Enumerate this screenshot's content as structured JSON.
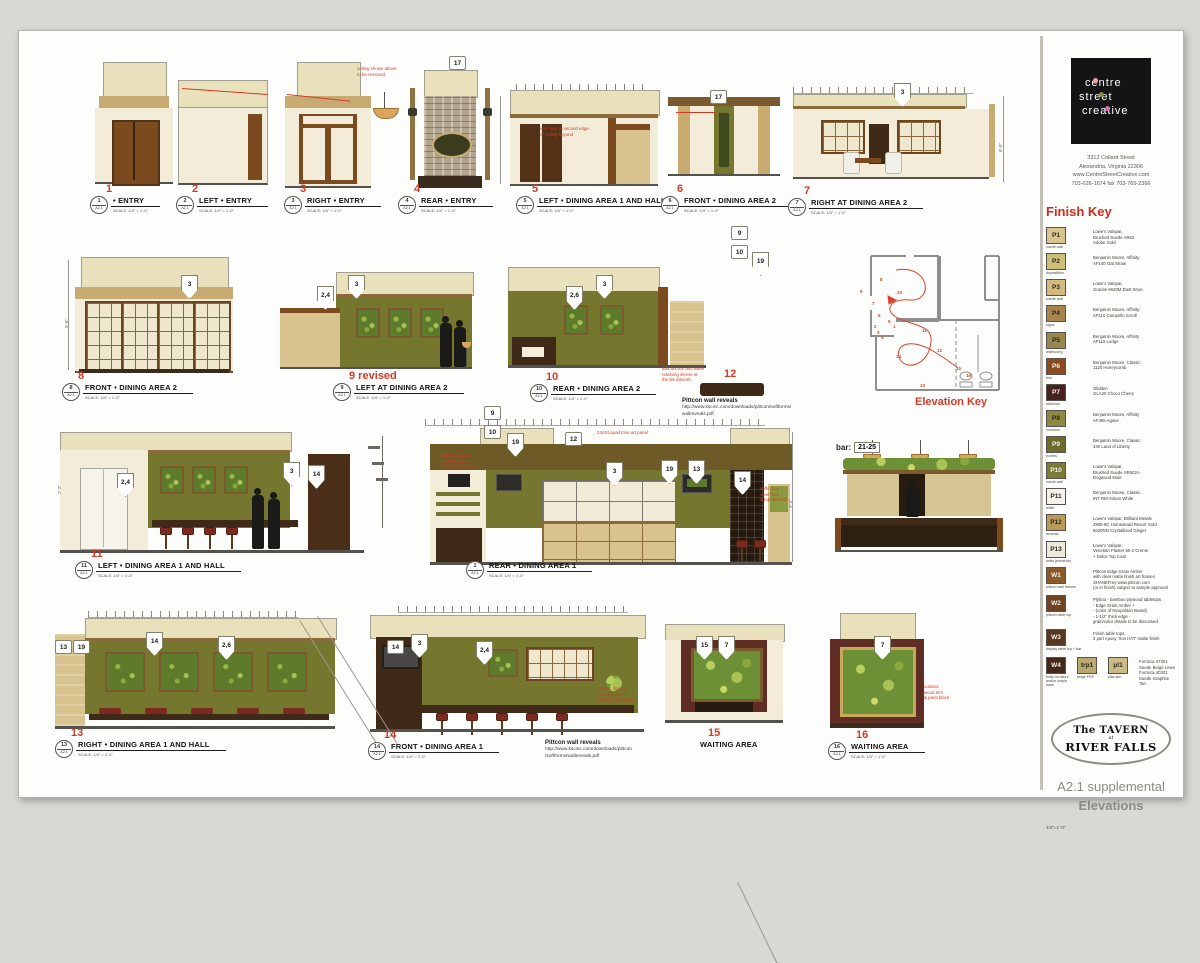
{
  "palette": {
    "accent_red": "#d03b28",
    "olive": "#75772e",
    "cream": "#e9e0bc",
    "tan": "#c8ab71",
    "walnut": "#3e2a17",
    "maroon": "#5f2d23"
  },
  "firm": {
    "name_lines": [
      "centre",
      "street",
      "creative"
    ],
    "address": [
      "3312 Collard Street",
      "Alexandria, Virginia 22306",
      "www.CentreStreetCreative.com",
      "703-626-1674  fax 703-765-2366"
    ]
  },
  "finish_key": {
    "title": "Finish Key",
    "items": [
      {
        "code": "P1",
        "sub": "suede wall",
        "swatch": "#d8c58d",
        "desc": [
          "Lowe's Valspar,",
          "Brushed Suede AR62",
          "Adobe Gold"
        ]
      },
      {
        "code": "P2",
        "sub": "drywall/trim",
        "swatch": "#cdbf7a",
        "desc": [
          "Benjamin Moore, Affinity",
          "AF140 Oat Straw"
        ]
      },
      {
        "code": "P3",
        "sub": "suede wall",
        "swatch": "#d2ba7f",
        "desc": [
          "Lowe's Valspar,",
          "Granite 6620M Dust Shoe"
        ]
      },
      {
        "code": "P4",
        "sub": "signs",
        "swatch": "#a8854c",
        "desc": [
          "Benjamin Moore, Affinity",
          "AF110 Campello Scroll"
        ]
      },
      {
        "code": "P5",
        "sub": "wainscot'g",
        "swatch": "#99884e",
        "desc": [
          "Benjamin Moore, Affinity",
          "AF115 Lodge"
        ]
      },
      {
        "code": "P6",
        "sub": "trim",
        "swatch": "#8c4a22",
        "desc": [
          "Benjamin Moore, Classic",
          "1120 Honeycomb"
        ]
      },
      {
        "code": "P7",
        "sub": "windows",
        "swatch": "#46231e",
        "desc": [
          "Glidden",
          "GLA20 Choco Cherry"
        ]
      },
      {
        "code": "P8",
        "sub": "corridors",
        "swatch": "#8b8a40",
        "desc": [
          "Benjamin Moore, Affinity",
          "AF465 Agave"
        ]
      },
      {
        "code": "P9",
        "sub": "booths",
        "swatch": "#6b6c2d",
        "desc": [
          "Benjamin Moore, Classic",
          "440 Land of Liberty"
        ]
      },
      {
        "code": "P10",
        "sub": "suede wall",
        "swatch": "#7c7c38",
        "desc": [
          "Lowe's Valspar,",
          "Brushed Suede SR502A",
          "Dogwood Mole"
        ]
      },
      {
        "code": "P11",
        "sub": "white",
        "swatch": "#f4f2ea",
        "desc": [
          "Benjamin Moore, Classic",
          "INT RM Atrium White"
        ]
      },
      {
        "code": "P12",
        "sub": "accents",
        "swatch": "#b99a58",
        "desc": [
          "Lowe's Valspar, Brilliant Metals",
          "2905-8C Homestead Resort Gold",
          "6620NN Crystallized Ginger"
        ]
      },
      {
        "code": "P13",
        "sub": "walls (entrance)",
        "swatch": "#efe9da",
        "desc": [
          "Lowe's Valspar,",
          "Venetian Plaster 50-2 Creme",
          "+ Dolce Top Coat"
        ]
      },
      {
        "code": "W1",
        "sub": "pittcon wall frames",
        "swatch": "#8a5a2a",
        "desc": [
          "Pittcon Edge Grain Amber",
          "with clear matte finish art frames",
          "SHANEFrey www.pittcon.com",
          "(or in finish) subject to sample approval"
        ]
      },
      {
        "code": "W2",
        "sub": "pittcon table top",
        "swatch": "#6e4523",
        "desc": [
          "Plyboo - bamboo plywood tabletops",
          "- Edge Grain Amber +",
          "- (color of Neopolitan Board)",
          "- 1-1/2\" thick edge -",
          "  grain/color details to be discussed"
        ]
      },
      {
        "code": "W3",
        "sub": "display table top + bar",
        "swatch": "#57371f",
        "desc": [
          "Finish table tops:",
          "2 part epoxy 'Iron HAT' matte finish"
        ]
      }
    ],
    "bottom_row": {
      "items": [
        {
          "code": "W4",
          "sub": "finish furniture and/or maple base",
          "swatch": "#42291a"
        },
        {
          "code": "trp1",
          "sub": "beige FRP",
          "swatch": "#b9a96e"
        },
        {
          "code": "pl1",
          "sub": "plas lam",
          "swatch": "#cbbc85"
        }
      ],
      "desc": [
        "Formica 47301 Suede Beige Linen",
        "Formica 40301 Suede Graphite Tan"
      ]
    }
  },
  "title_block": {
    "tavern_line1": "The TAVERN",
    "tavern_line2": "at",
    "tavern_line3": "RIVER FALLS",
    "sheet_number": "A2.1 supplemental",
    "sheet_name": "Elevations",
    "sheet_scale": "1/4\"=1'-0\""
  },
  "labels": {
    "scale": "SCALE: 1/4\" = 1'-0\"",
    "sheet": "A2.1"
  },
  "elevation_key_label": "Elevation Key",
  "bar_note": {
    "prefix": "bar:",
    "tag": "21-25"
  },
  "elevations": [
    {
      "num": "1",
      "sym": "1",
      "title": "• ENTRY"
    },
    {
      "num": "2",
      "sym": "2",
      "title": "LEFT • ENTRY"
    },
    {
      "num": "3",
      "sym": "3",
      "title": "RIGHT • ENTRY"
    },
    {
      "num": "4",
      "sym": "4",
      "title": "REAR • ENTRY"
    },
    {
      "num": "5",
      "sym": "5",
      "title": "LEFT • DINING AREA 1 AND HALL"
    },
    {
      "num": "6",
      "sym": "6",
      "title": "FRONT • DINING AREA 2"
    },
    {
      "num": "7",
      "sym": "7",
      "title": "RIGHT AT DINING AREA 2"
    },
    {
      "num": "8",
      "sym": "8",
      "title": "FRONT • DINING AREA 2"
    },
    {
      "num": "9 revised",
      "sym": "9",
      "title": "LEFT AT DINING AREA 2"
    },
    {
      "num": "10",
      "sym": "10",
      "title": "REAR • DINING AREA 2"
    },
    {
      "num": "11",
      "sym": "11",
      "title": "LEFT • DINING AREA 1 AND HALL"
    },
    {
      "num": "12",
      "sym": "",
      "title": ""
    },
    {
      "num": "",
      "sym": "1",
      "title": "REAR • DINING AREA 1"
    },
    {
      "num": "13",
      "sym": "13",
      "title": "RIGHT • DINING AREA 1 AND  HALL"
    },
    {
      "num": "14",
      "sym": "14",
      "title": "FRONT • DINING AREA 1"
    },
    {
      "num": "15",
      "sym": "",
      "title": "WAITING AREA"
    },
    {
      "num": "16",
      "sym": "16",
      "title": "WAITING AREA"
    }
  ],
  "markers": [
    {
      "x": 449,
      "y": 56,
      "t": "17",
      "s": "box"
    },
    {
      "x": 710,
      "y": 90,
      "t": "17",
      "s": "box"
    },
    {
      "x": 894,
      "y": 83,
      "t": "3"
    },
    {
      "x": 181,
      "y": 275,
      "t": "3"
    },
    {
      "x": 317,
      "y": 286,
      "t": "2,4"
    },
    {
      "x": 348,
      "y": 275,
      "t": "3"
    },
    {
      "x": 566,
      "y": 286,
      "t": "2,6"
    },
    {
      "x": 596,
      "y": 275,
      "t": "3"
    },
    {
      "x": 731,
      "y": 226,
      "t": "9",
      "s": "box"
    },
    {
      "x": 731,
      "y": 245,
      "t": "10",
      "s": "box"
    },
    {
      "x": 752,
      "y": 252,
      "t": "19"
    },
    {
      "x": 117,
      "y": 473,
      "t": "2,4"
    },
    {
      "x": 283,
      "y": 462,
      "t": "3"
    },
    {
      "x": 308,
      "y": 465,
      "t": "14"
    },
    {
      "x": 484,
      "y": 406,
      "t": "9",
      "s": "box"
    },
    {
      "x": 484,
      "y": 425,
      "t": "10",
      "s": "box"
    },
    {
      "x": 507,
      "y": 433,
      "t": "19"
    },
    {
      "x": 565,
      "y": 432,
      "t": "12",
      "s": "box"
    },
    {
      "x": 606,
      "y": 462,
      "t": "3"
    },
    {
      "x": 661,
      "y": 460,
      "t": "19"
    },
    {
      "x": 688,
      "y": 460,
      "t": "13"
    },
    {
      "x": 734,
      "y": 471,
      "t": "14"
    },
    {
      "x": 55,
      "y": 640,
      "t": "13",
      "s": "box"
    },
    {
      "x": 73,
      "y": 640,
      "t": "19",
      "s": "box"
    },
    {
      "x": 146,
      "y": 632,
      "t": "14"
    },
    {
      "x": 218,
      "y": 636,
      "t": "2,6"
    },
    {
      "x": 387,
      "y": 640,
      "t": "14",
      "s": "box"
    },
    {
      "x": 411,
      "y": 634,
      "t": "3"
    },
    {
      "x": 476,
      "y": 641,
      "t": "2,4"
    },
    {
      "x": 696,
      "y": 636,
      "t": "15"
    },
    {
      "x": 718,
      "y": 636,
      "t": "7"
    },
    {
      "x": 874,
      "y": 636,
      "t": "7"
    }
  ],
  "annotations": [
    {
      "x": 357,
      "y": 66,
      "lines": [
        "ceiling shown above",
        "to be removed"
      ]
    },
    {
      "x": 540,
      "y": 126,
      "lines": [
        "arch way to second edge",
        "of ceiling beyond"
      ]
    },
    {
      "x": 662,
      "y": 366,
      "lines": [
        "add anchor and water",
        "retaining sleeve at",
        "the tile artwork"
      ]
    },
    {
      "x": 441,
      "y": 453,
      "lines": [
        "Pittcon drywall",
        "reveal/bead to",
        "drywall paint edge"
      ]
    },
    {
      "x": 597,
      "y": 430,
      "lines": [
        "24x34 quad tone art panel"
      ]
    },
    {
      "x": 760,
      "y": 486,
      "lines": [
        "soffit drop",
        "steel floor",
        "& top finished"
      ]
    },
    {
      "x": 924,
      "y": 684,
      "lines": [
        "outdoor",
        "wood trim",
        "& paint black"
      ]
    },
    {
      "x": 598,
      "y": 686,
      "lines": [
        "Pittcon drywall",
        "reveal/bead at",
        "drywall paint edge"
      ]
    }
  ],
  "pittcon_notes": [
    {
      "x": 682,
      "y": 397,
      "title": "Pittcon wall reveals",
      "lines": [
        "http://www.kscinc.com/downloads/pittcon/softforms/",
        "wallreveals.pdf"
      ]
    },
    {
      "x": 545,
      "y": 739,
      "title": "Pittcon wall reveals",
      "lines": [
        "http://www.kscinc.com/downloads/pittcon",
        "/softforms/wallreveals.pdf"
      ]
    }
  ],
  "dims": [
    {
      "x": 998,
      "y": 152,
      "label": "8'-0\""
    },
    {
      "x": 64,
      "y": 328,
      "label": "9'-6\""
    },
    {
      "x": 788,
      "y": 508,
      "label": "9'-2\""
    },
    {
      "x": 57,
      "y": 494,
      "label": "7'-2\""
    }
  ],
  "key_numbers": [
    {
      "x": 55,
      "y": 84,
      "t": "1"
    },
    {
      "x": 36,
      "y": 84,
      "t": "2"
    },
    {
      "x": 39,
      "y": 90,
      "t": "3"
    },
    {
      "x": 43,
      "y": 95,
      "t": "4"
    },
    {
      "x": 50,
      "y": 79,
      "t": "5"
    },
    {
      "x": 40,
      "y": 73,
      "t": "6"
    },
    {
      "x": 34,
      "y": 61,
      "t": "7"
    },
    {
      "x": 42,
      "y": 37,
      "t": "8"
    },
    {
      "x": 22,
      "y": 49,
      "t": "9"
    },
    {
      "x": 59,
      "y": 50,
      "t": "10"
    },
    {
      "x": 84,
      "y": 88,
      "t": "11"
    },
    {
      "x": 99,
      "y": 108,
      "t": "12"
    },
    {
      "x": 82,
      "y": 143,
      "t": "13"
    },
    {
      "x": 58,
      "y": 114,
      "t": "14"
    },
    {
      "x": 118,
      "y": 126,
      "t": "15"
    },
    {
      "x": 128,
      "y": 133,
      "t": "16"
    }
  ]
}
